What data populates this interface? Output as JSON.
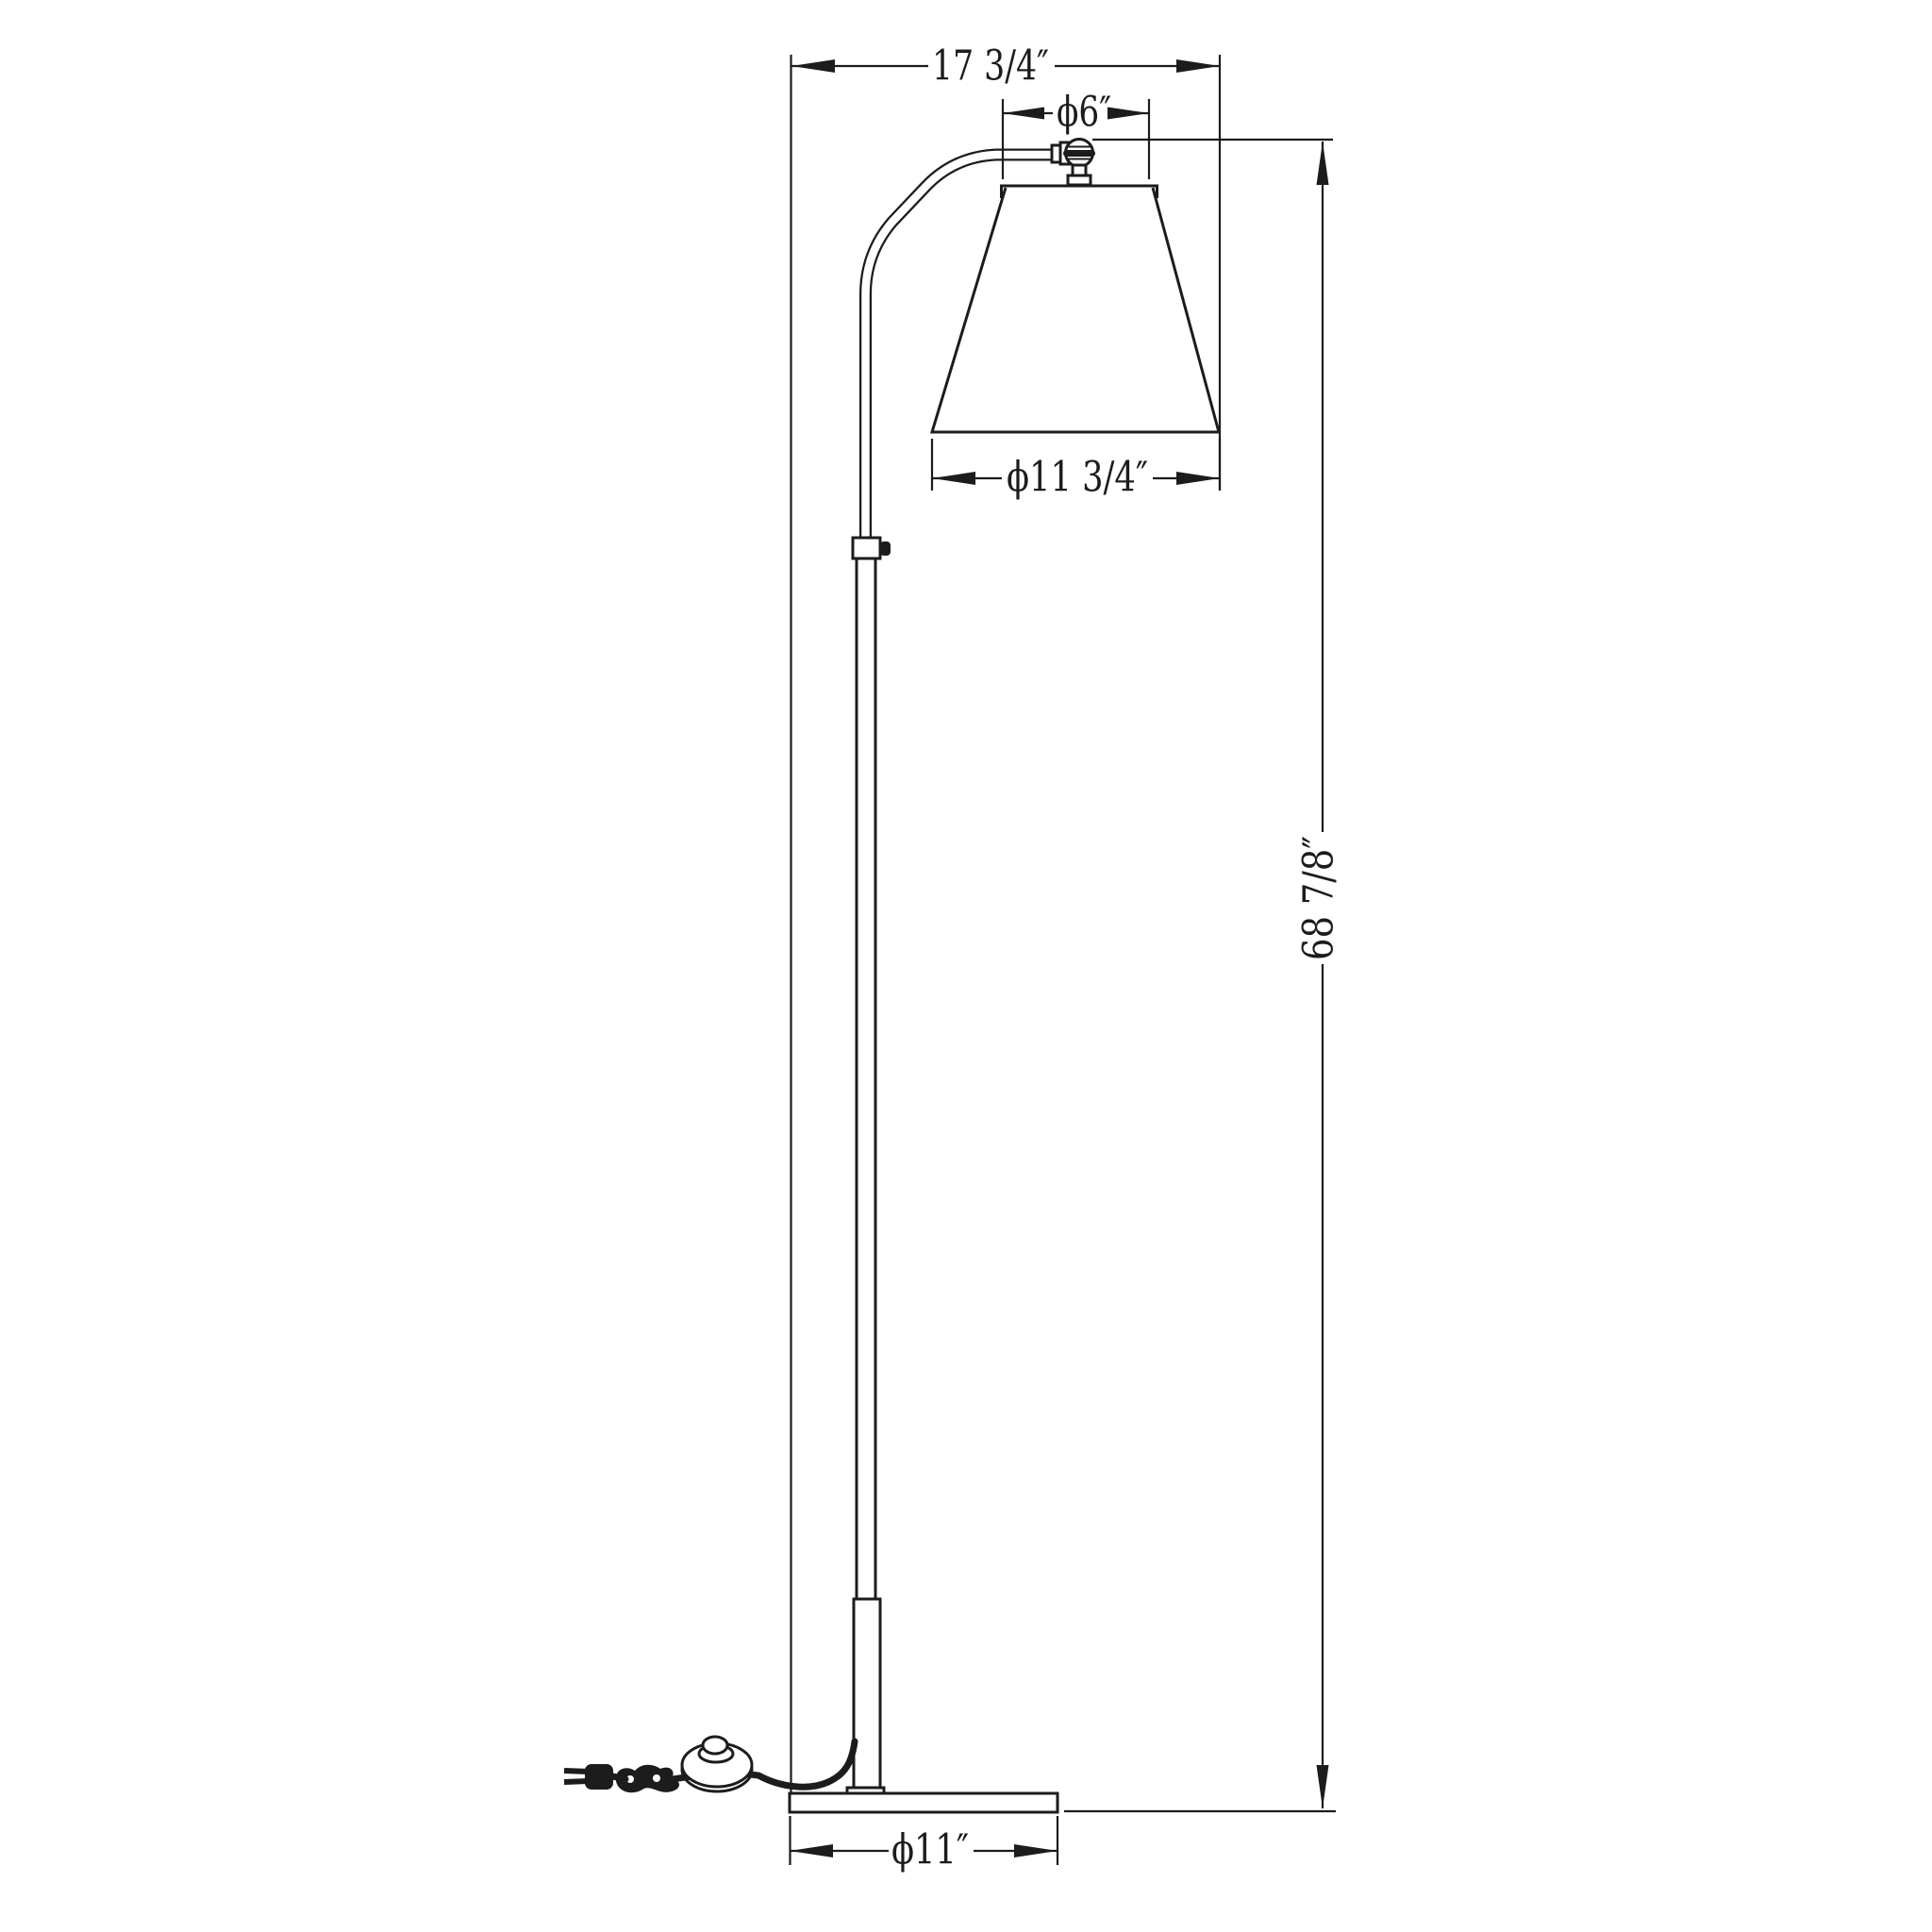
{
  "page": {
    "background": "#ffffff",
    "line_color": "#1c1c1c"
  },
  "drawing": {
    "kind": "technical-dimension-diagram",
    "labels": {
      "overall_width": "17 3/4″",
      "shade_top_diameter": "ϕ6″",
      "shade_bottom_diameter": "ϕ11 3/4″",
      "overall_height": "68 7/8″",
      "base_diameter": "ϕ11″"
    }
  }
}
